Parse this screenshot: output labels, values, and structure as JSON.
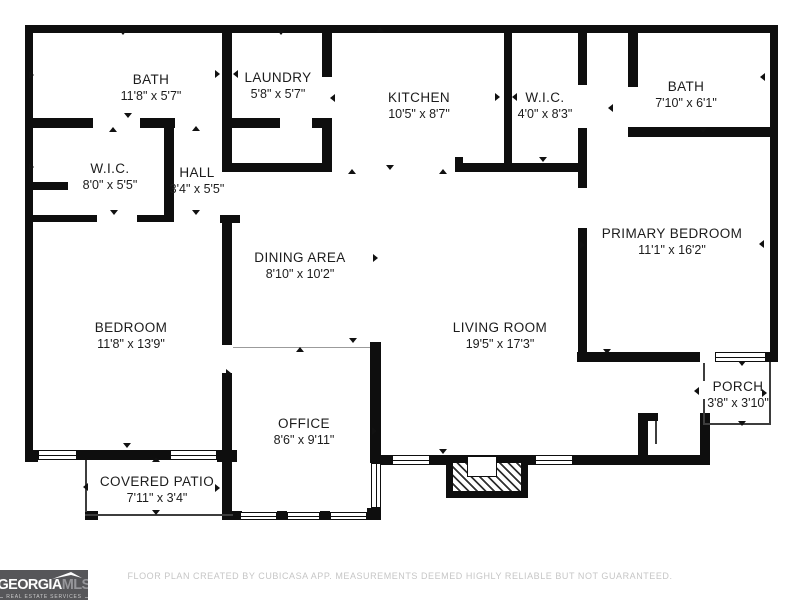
{
  "footer": {
    "disclaimer": "FLOOR PLAN CREATED BY CUBICASA APP. MEASUREMENTS DEEMED HIGHLY RELIABLE BUT NOT GUARANTEED."
  },
  "logo": {
    "brand_primary": "GEORGIA",
    "brand_secondary": "MLS",
    "tagline": "REAL ESTATE SERVICES",
    "bg": "#565659"
  },
  "plan": {
    "wall_color": "#0e0e0e",
    "background": "#ffffff",
    "rooms": [
      {
        "name": "BATH",
        "dims": "11'8\" x 5'7\"",
        "cx": 151,
        "cy": 88
      },
      {
        "name": "LAUNDRY",
        "dims": "5'8\" x 5'7\"",
        "cx": 278,
        "cy": 86
      },
      {
        "name": "KITCHEN",
        "dims": "10'5\" x 8'7\"",
        "cx": 419,
        "cy": 106
      },
      {
        "name": "W.I.C.",
        "dims": "4'0\" x 8'3\"",
        "cx": 545,
        "cy": 106
      },
      {
        "name": "BATH",
        "dims": "7'10\" x 6'1\"",
        "cx": 686,
        "cy": 95
      },
      {
        "name": "W.I.C.",
        "dims": "8'0\" x 5'5\"",
        "cx": 110,
        "cy": 177
      },
      {
        "name": "HALL",
        "dims": "3'4\" x 5'5\"",
        "cx": 197,
        "cy": 181
      },
      {
        "name": "DINING AREA",
        "dims": "8'10\" x 10'2\"",
        "cx": 300,
        "cy": 266
      },
      {
        "name": "PRIMARY BEDROOM",
        "dims": "11'1\" x 16'2\"",
        "cx": 672,
        "cy": 242
      },
      {
        "name": "BEDROOM",
        "dims": "11'8\" x 13'9\"",
        "cx": 131,
        "cy": 336
      },
      {
        "name": "LIVING ROOM",
        "dims": "19'5\" x 17'3\"",
        "cx": 500,
        "cy": 336
      },
      {
        "name": "OFFICE",
        "dims": "8'6\" x 9'11\"",
        "cx": 304,
        "cy": 432
      },
      {
        "name": "PORCH",
        "dims": "3'8\" x 3'10\"",
        "cx": 738,
        "cy": 395
      },
      {
        "name": "COVERED PATIO",
        "dims": "7'11\" x 3'4\"",
        "cx": 157,
        "cy": 490
      }
    ],
    "walls": [
      [
        25,
        25,
        753,
        8
      ],
      [
        25,
        25,
        8,
        437
      ],
      [
        770,
        25,
        8,
        337
      ],
      [
        25,
        450,
        13,
        12
      ],
      [
        77,
        450,
        93,
        10
      ],
      [
        217,
        450,
        20,
        12
      ],
      [
        577,
        352,
        123,
        10
      ],
      [
        766,
        352,
        12,
        10
      ],
      [
        380,
        455,
        12,
        10
      ],
      [
        430,
        455,
        16,
        10
      ],
      [
        528,
        455,
        7,
        10
      ],
      [
        573,
        455,
        137,
        10
      ],
      [
        638,
        413,
        10,
        52
      ],
      [
        638,
        413,
        20,
        8
      ],
      [
        700,
        413,
        10,
        52
      ],
      [
        222,
        25,
        10,
        105
      ],
      [
        164,
        118,
        10,
        104
      ],
      [
        222,
        130,
        10,
        42
      ],
      [
        220,
        215,
        20,
        8
      ],
      [
        222,
        215,
        10,
        130
      ],
      [
        222,
        373,
        10,
        147
      ],
      [
        322,
        25,
        10,
        52
      ],
      [
        322,
        118,
        10,
        54
      ],
      [
        504,
        25,
        8,
        147
      ],
      [
        578,
        25,
        9,
        60
      ],
      [
        578,
        128,
        9,
        60
      ],
      [
        578,
        228,
        9,
        134
      ],
      [
        628,
        25,
        10,
        62
      ],
      [
        370,
        342,
        11,
        121
      ],
      [
        367,
        508,
        14,
        12
      ],
      [
        25,
        118,
        68,
        10
      ],
      [
        140,
        118,
        35,
        10
      ],
      [
        25,
        215,
        72,
        7
      ],
      [
        137,
        215,
        36,
        7
      ],
      [
        25,
        182,
        43,
        8
      ],
      [
        232,
        118,
        48,
        10
      ],
      [
        312,
        118,
        20,
        10
      ],
      [
        222,
        163,
        110,
        9
      ],
      [
        455,
        157,
        8,
        15
      ],
      [
        462,
        163,
        125,
        9
      ],
      [
        628,
        127,
        150,
        10
      ],
      [
        230,
        511,
        12,
        9
      ],
      [
        277,
        511,
        10,
        9
      ],
      [
        320,
        511,
        10,
        9
      ],
      [
        85,
        511,
        13,
        9
      ]
    ],
    "windows": [
      [
        38,
        450,
        39,
        10,
        "h"
      ],
      [
        170,
        450,
        47,
        10,
        "h"
      ],
      [
        715,
        352,
        51,
        10,
        "h"
      ],
      [
        392,
        455,
        38,
        10,
        "h"
      ],
      [
        535,
        455,
        38,
        10,
        "h"
      ],
      [
        371,
        463,
        10,
        45,
        "v"
      ],
      [
        240,
        512,
        37,
        8,
        "h"
      ],
      [
        287,
        512,
        33,
        8,
        "h"
      ],
      [
        330,
        512,
        37,
        8,
        "h"
      ]
    ],
    "thin_lines": [
      [
        233,
        347,
        137,
        1,
        "light"
      ],
      [
        85,
        460,
        2,
        52,
        ""
      ],
      [
        85,
        514,
        148,
        2,
        ""
      ],
      [
        769,
        362,
        2,
        63,
        ""
      ],
      [
        703,
        423,
        68,
        2,
        ""
      ],
      [
        703,
        363,
        2,
        18,
        ""
      ],
      [
        703,
        399,
        2,
        26,
        ""
      ],
      [
        655,
        421,
        2,
        23,
        ""
      ]
    ],
    "fireplace": {
      "outer": [
        446,
        455,
        82,
        43
      ],
      "hatch": [
        453,
        463,
        68,
        28
      ],
      "box": [
        467,
        456,
        30,
        21
      ]
    },
    "arrows": [
      [
        123,
        33,
        "down"
      ],
      [
        281,
        33,
        "down"
      ],
      [
        380,
        30,
        "up"
      ],
      [
        33,
        74,
        "right"
      ],
      [
        219,
        73,
        "right"
      ],
      [
        237,
        73,
        "left"
      ],
      [
        128,
        116,
        "down"
      ],
      [
        113,
        130,
        "up"
      ],
      [
        196,
        129,
        "up"
      ],
      [
        196,
        213,
        "down"
      ],
      [
        114,
        213,
        "down"
      ],
      [
        33,
        166,
        "right"
      ],
      [
        334,
        97,
        "left"
      ],
      [
        352,
        172,
        "up"
      ],
      [
        390,
        168,
        "down"
      ],
      [
        443,
        172,
        "up"
      ],
      [
        499,
        96,
        "right"
      ],
      [
        516,
        96,
        "left"
      ],
      [
        543,
        160,
        "down"
      ],
      [
        612,
        107,
        "left"
      ],
      [
        703,
        131,
        "down"
      ],
      [
        764,
        76,
        "left"
      ],
      [
        584,
        244,
        "right"
      ],
      [
        763,
        243,
        "left"
      ],
      [
        607,
        352,
        "down"
      ],
      [
        742,
        364,
        "down"
      ],
      [
        698,
        390,
        "left"
      ],
      [
        766,
        392,
        "right"
      ],
      [
        742,
        424,
        "down"
      ],
      [
        443,
        452,
        "down"
      ],
      [
        377,
        257,
        "right"
      ],
      [
        300,
        350,
        "up"
      ],
      [
        353,
        341,
        "down"
      ],
      [
        230,
        372,
        "right"
      ],
      [
        376,
        430,
        "right"
      ],
      [
        127,
        446,
        "down"
      ],
      [
        156,
        460,
        "up"
      ],
      [
        156,
        513,
        "down"
      ],
      [
        87,
        486,
        "left"
      ],
      [
        219,
        487,
        "right"
      ]
    ]
  }
}
